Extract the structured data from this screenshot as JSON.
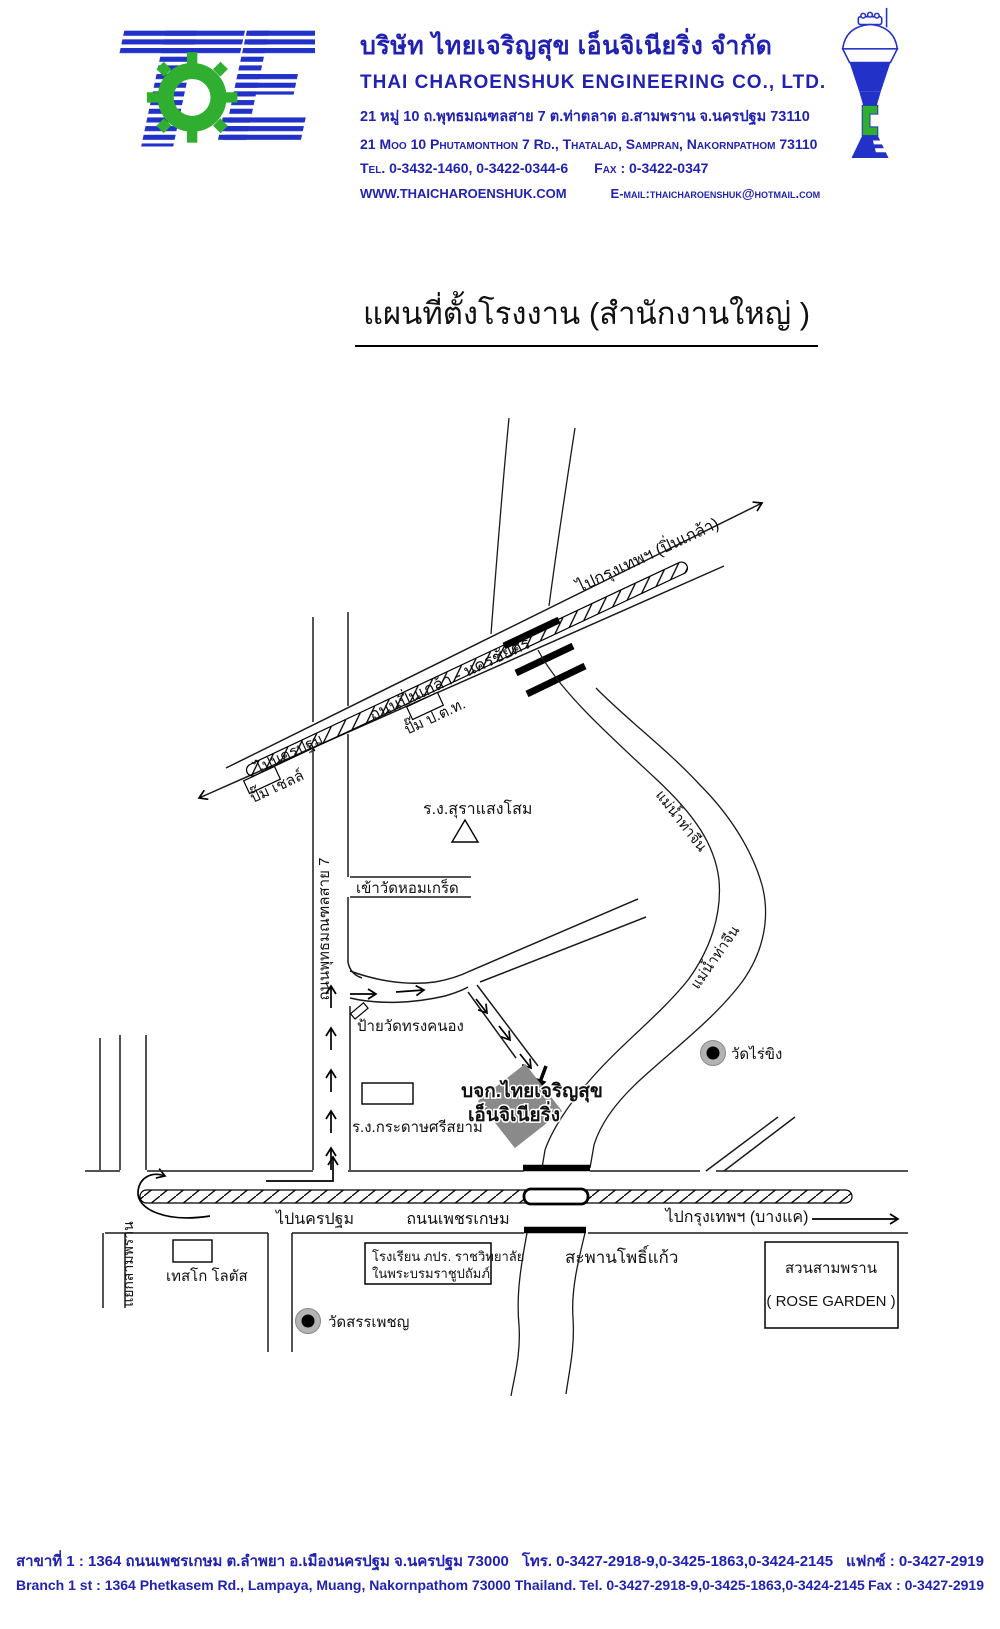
{
  "title": "แผนที่ตั้งโรงงาน (สำนักงานใหญ่ )",
  "header": {
    "company_th": "บริษัท ไทยเจริญสุข เอ็นจิเนียริ่ง จำกัด",
    "company_en": "THAI CHAROENSHUK ENGINEERING CO., LTD.",
    "address_th": "21 หมู่ 10 ถ.พุทธมณฑลสาย 7 ต.ท่าตลาด อ.สามพราน จ.นครปฐม 73110",
    "address_en": "21 Moo 10 Phutamonthon 7 Rd., Thatalad, Sampran, Nakornpathom 73110",
    "tel": "Tel. 0-3432-1460, 0-3422-0344-6",
    "fax": "Fax : 0-3422-0347",
    "website": "WWW.THAICHAROENSHUK.COM",
    "email": "E-mail:thaicharoenshuk@hotmail.com",
    "logo_text": "TCE",
    "colors": {
      "blue": "#2232c8",
      "green": "#2fae2f",
      "text_blue": "#2222b2"
    }
  },
  "map": {
    "labels": {
      "to_bangkok_pinklao": "ไปกรุงเทพฯ (ปิ่นเกล้า)",
      "pinklao_road": "ถนนปิ่นเกล้า - นครชัยศรี",
      "ptt_station": "ปั๊ม ป.ต.ท.",
      "to_nakhonpathom_upper": "ไปนครปฐม",
      "shell_station": "ปั๊ม เชลล์",
      "sangsom_factory": "ร.ง.สุราแสงโสม",
      "wat_homkret_entrance": "เข้าวัดหอมเกร็ด",
      "sai7_road": "ถนนพุทธมณฑลสาย 7",
      "wat_songkhanong_sign": "ป้ายวัดทรงคนอง",
      "company_line1": "บจก.ไทยเจริญสุข",
      "company_line2": "เอ็นจิเนียริ่ง",
      "srisiam_paper_factory": "ร.ง.กระดาษศรีสยาม",
      "wat_raikhing": "วัดไร่ขิง",
      "tha_chin_river_upper": "แม่น้ำท่าจีน",
      "tha_chin_river_lower": "แม่น้ำท่าจีน",
      "to_nakhonpathom_lower": "ไปนครปฐม",
      "phetkasem_road": "ถนนเพชรเกษม",
      "to_bangkok_bangkae": "ไปกรุงเทพฯ (บางแค)",
      "pho_kaeo_bridge": "สะพานโพธิ์แก้ว",
      "school_line1": "โรงเรียน ภปร. ราชวิทยาลัย",
      "school_line2": "ในพระบรมราชูปถัมภ์",
      "tesco_lotus": "เทสโก โลตัส",
      "wat_sanphet": "วัดสรรเพชญ",
      "rose_garden_th": "สวนสามพราน",
      "rose_garden_en": "( ROSE GARDEN )",
      "sampran_junction": "แยกสามพราน"
    }
  },
  "footer": {
    "branch_th": "สาขาที่ 1  :  1364 ถนนเพชรเกษม ต.ลำพยา อ.เมืองนครปฐม จ.นครปฐม 73000",
    "branch_th_tel": "โทร. 0-3427-2918-9,0-3425-1863,0-3424-2145",
    "branch_th_fax": "แฟกซ์ : 0-3427-2919",
    "branch_en": "Branch 1 st : 1364 Phetkasem Rd., Lampaya, Muang, Nakornpathom 73000 Thailand.",
    "branch_en_tel": "Tel. 0-3427-2918-9,0-3425-1863,0-3424-2145",
    "branch_en_fax": "Fax : 0-3427-2919"
  }
}
